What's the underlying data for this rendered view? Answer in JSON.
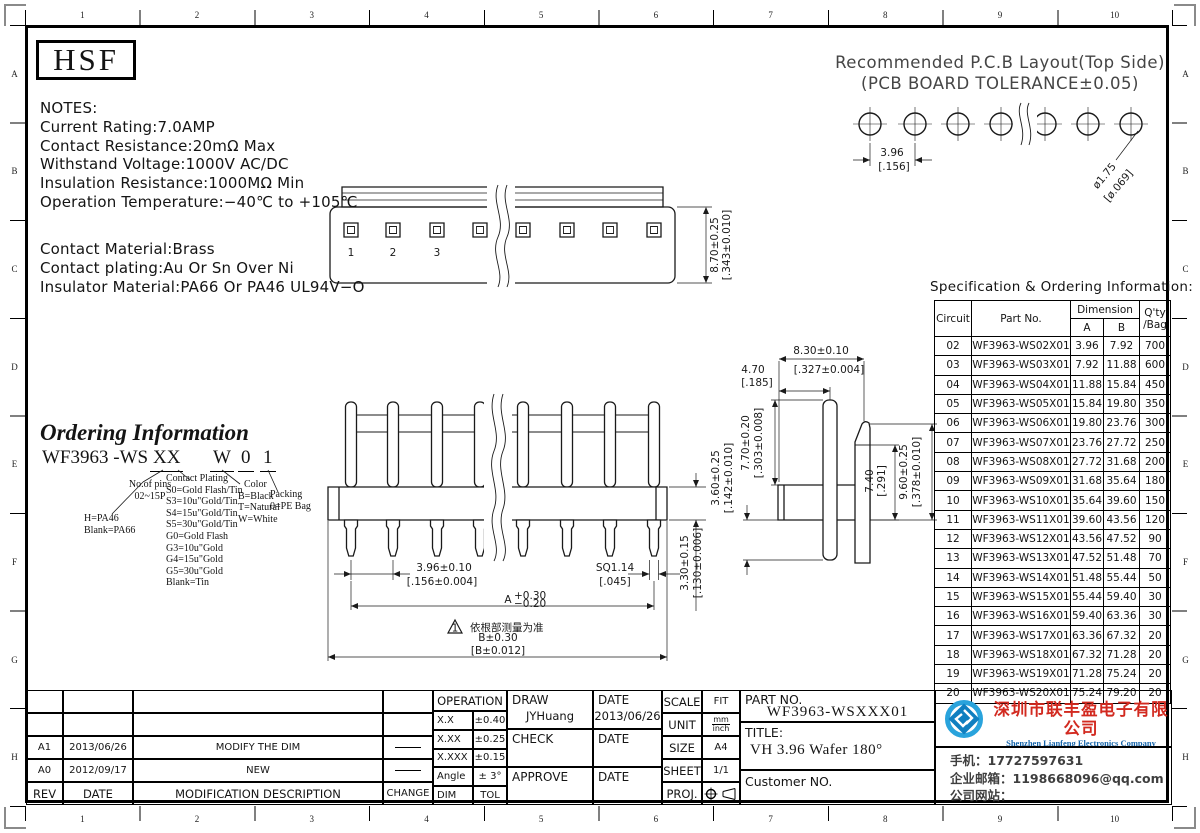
{
  "frame": {
    "zones_top": [
      "1",
      "2",
      "3",
      "4",
      "5",
      "6",
      "7",
      "8",
      "9",
      "10"
    ],
    "zones_bottom": [
      "1",
      "2",
      "3",
      "4",
      "5",
      "6",
      "7",
      "8",
      "9",
      "10"
    ],
    "zones_left": [
      "A",
      "B",
      "C",
      "D",
      "E",
      "F",
      "G",
      "H"
    ],
    "zones_right": [
      "A",
      "B",
      "C",
      "D",
      "E",
      "F",
      "G",
      "H"
    ]
  },
  "logo_text": "HSF",
  "notes": {
    "title": "NOTES:",
    "electrical": [
      "Current Rating:7.0AMP",
      "Contact Resistance:20mΩ Max",
      "Withstand Voltage:1000V AC/DC",
      "Insulation Resistance:1000MΩ Min",
      "Operation Temperature:−40℃ to +105℃"
    ],
    "material": [
      "Contact Material:Brass",
      "Contact plating:Au Or Sn Over Ni",
      "Insulator Material:PA66 Or PA46 UL94V−O"
    ]
  },
  "pcb": {
    "title_line1": "Recommended P.C.B Layout(Top Side)",
    "title_line2": "(PCB BOARD TOLERANCE±0.05)",
    "pitch": "3.96",
    "pitch_in": "[.156]",
    "hole": "ø1.75",
    "hole_in": "[ø.069]"
  },
  "ordering": {
    "title": "Ordering Information",
    "part_base": "WF3963 -WS",
    "part_pins": "XX",
    "part_color": "W",
    "part_packing": "0",
    "part_rev": "1",
    "pins_label": "No.of pins",
    "pins_range": "02~15P",
    "material_lines": [
      "H=PA46",
      "Blank=PA66"
    ],
    "plating_label": "Contact Plating",
    "plating_lines": [
      "S0=Gold Flash/Tin",
      "S3=10u\"Gold/Tin",
      "S4=15u\"Gold/Tin",
      "S5=30u\"Gold/Tin",
      "G0=Gold Flash",
      "G3=10u\"Gold",
      "G4=15u\"Gold",
      "G5=30u\"Gold",
      "Blank=Tin"
    ],
    "color_label": "Color",
    "color_lines": [
      "B=Black",
      "T=Natural",
      "W=White"
    ],
    "packing_label": "Packing",
    "packing_lines": [
      "0=PE Bag"
    ]
  },
  "drawings": {
    "top_view": {
      "pins": [
        "1",
        "2",
        "3"
      ],
      "height": "8.70±0.25",
      "height_in": "[.343±0.010]"
    },
    "front_view": {
      "pitch": "3.96±0.10",
      "pitch_in": "[.156±0.004]",
      "sq": "SQ1.14",
      "sq_in": "[.045]",
      "a": "A",
      "a_tol_up": "+0.30",
      "a_tol_dn": "−0.20",
      "note_flag": "1",
      "note_cn": "依根部测量为准",
      "b": "B±0.30",
      "b_in": "[B±0.012]",
      "bar_h": "3.30±0.15",
      "bar_h_in": "[.130±0.006]"
    },
    "side_view": {
      "w": "8.30±0.10",
      "w_in": "[.327±0.004]",
      "offset": "4.70",
      "offset_in": "[.185]",
      "pin_up": "7.70±0.20",
      "pin_up_in": "[.303±0.008]",
      "pin_dn": "3.60±0.25",
      "pin_dn_in": "[.142±0.010]",
      "lock": "7.40",
      "lock_in": "[.291]",
      "lock_h": "9.60±0.25",
      "lock_h_in": "[.378±0.010]"
    }
  },
  "spec": {
    "title": "Specification & Ordering Information:",
    "col_circuit": "Circuit",
    "col_part": "Part No.",
    "col_dim": "Dimension",
    "col_a": "A",
    "col_b": "B",
    "col_qty1": "Q'ty",
    "col_qty2": "/Bag",
    "rows": [
      [
        "02",
        "WF3963-WS02X01",
        "3.96",
        "7.92",
        "700"
      ],
      [
        "03",
        "WF3963-WS03X01",
        "7.92",
        "11.88",
        "600"
      ],
      [
        "04",
        "WF3963-WS04X01",
        "11.88",
        "15.84",
        "450"
      ],
      [
        "05",
        "WF3963-WS05X01",
        "15.84",
        "19.80",
        "350"
      ],
      [
        "06",
        "WF3963-WS06X01",
        "19.80",
        "23.76",
        "300"
      ],
      [
        "07",
        "WF3963-WS07X01",
        "23.76",
        "27.72",
        "250"
      ],
      [
        "08",
        "WF3963-WS08X01",
        "27.72",
        "31.68",
        "200"
      ],
      [
        "09",
        "WF3963-WS09X01",
        "31.68",
        "35.64",
        "180"
      ],
      [
        "10",
        "WF3963-WS10X01",
        "35.64",
        "39.60",
        "150"
      ],
      [
        "11",
        "WF3963-WS11X01",
        "39.60",
        "43.56",
        "120"
      ],
      [
        "12",
        "WF3963-WS12X01",
        "43.56",
        "47.52",
        "90"
      ],
      [
        "13",
        "WF3963-WS13X01",
        "47.52",
        "51.48",
        "70"
      ],
      [
        "14",
        "WF3963-WS14X01",
        "51.48",
        "55.44",
        "50"
      ],
      [
        "15",
        "WF3963-WS15X01",
        "55.44",
        "59.40",
        "30"
      ],
      [
        "16",
        "WF3963-WS16X01",
        "59.40",
        "63.36",
        "30"
      ],
      [
        "17",
        "WF3963-WS17X01",
        "63.36",
        "67.32",
        "20"
      ],
      [
        "18",
        "WF3963-WS18X01",
        "67.32",
        "71.28",
        "20"
      ],
      [
        "19",
        "WF3963-WS19X01",
        "71.28",
        "75.24",
        "20"
      ],
      [
        "20",
        "WF3963-WS20X01",
        "75.24",
        "79.20",
        "20"
      ]
    ]
  },
  "revisions": {
    "rows": [
      [
        "A1",
        "2013/06/26",
        "MODIFY THE DIM"
      ],
      [
        "A0",
        "2012/09/17",
        "NEW"
      ]
    ],
    "footer": [
      "REV",
      "DATE",
      "MODIFICATION  DESCRIPTION",
      "CHANGE"
    ]
  },
  "titleblock": {
    "operation": "OPERATION",
    "tol_rows": [
      [
        "X.X",
        "±0.40"
      ],
      [
        "X.XX",
        "±0.25"
      ],
      [
        "X.XXX",
        "±0.15"
      ],
      [
        "Angle",
        "± 3°"
      ],
      [
        "DIM",
        "TOL"
      ]
    ],
    "draw": "DRAW",
    "draw_name": "JYHuang",
    "date": "DATE",
    "draw_date": "2013/06/26",
    "check": "CHECK",
    "approve": "APPROVE",
    "scale": "SCALE",
    "scale_v": "FIT",
    "unit": "UNIT",
    "unit_mm": "mm",
    "unit_inch": "inch",
    "size": "SIZE",
    "size_v": "A4",
    "sheet": "SHEET",
    "sheet_v": "1/1",
    "proj": "PROJ.",
    "part_label": "PART NO.",
    "part_no": "WF3963-WSXXX01",
    "title_label": "TITLE:",
    "title": "VH 3.96 Wafer 180°",
    "customer_label": "Customer NO."
  },
  "company": {
    "name_cn": "深圳市联丰盈电子有限公司",
    "name_en": "Shenzhen Lianfeng Electronics Company Limited",
    "phone": "手机：17727597631",
    "email": "企业邮箱：1198668096@qq.com",
    "website": "公司网站：http://www.szlfying.com"
  }
}
